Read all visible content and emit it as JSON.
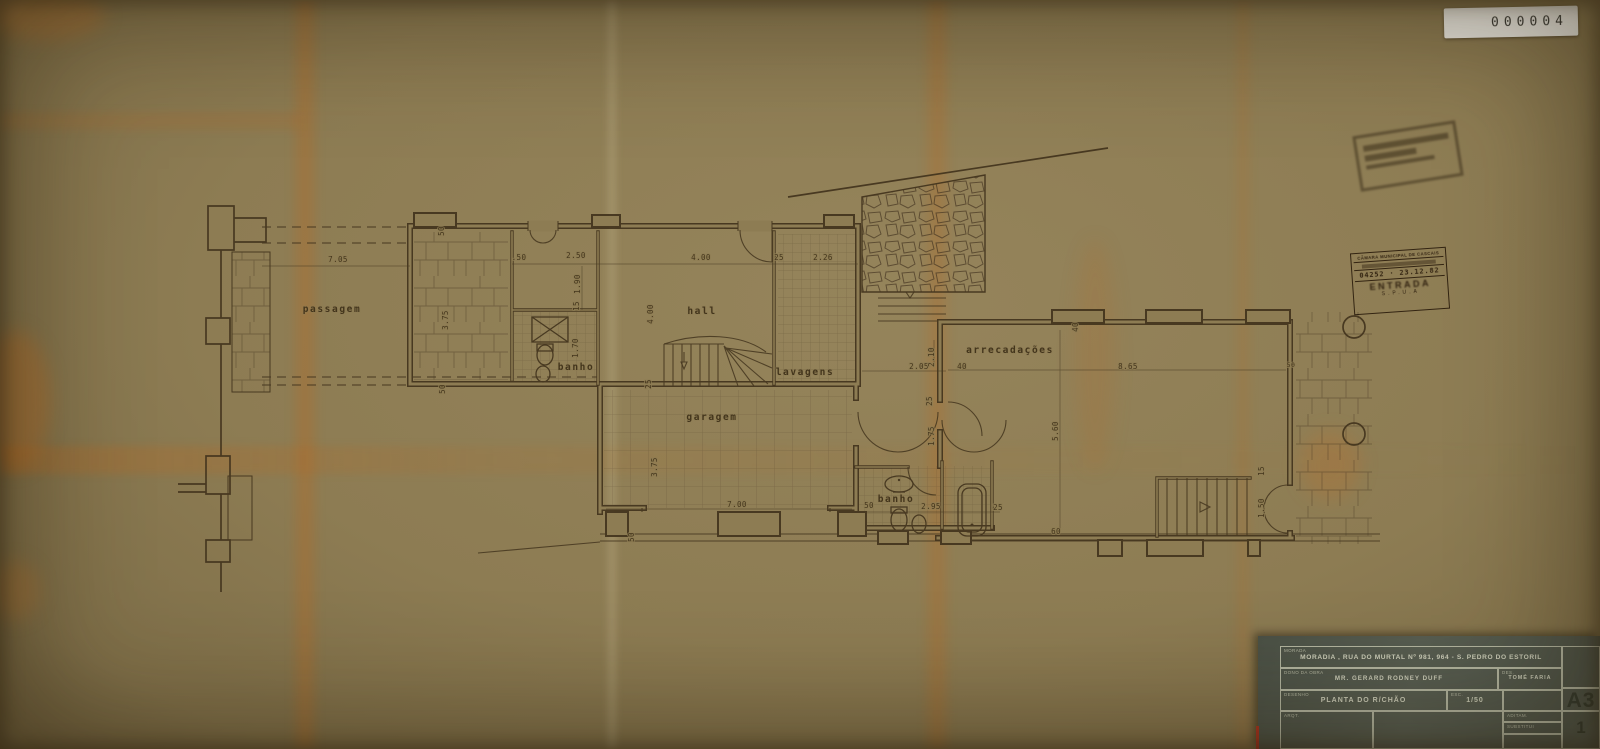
{
  "page": {
    "serial": "000004"
  },
  "stamps": {
    "entry": {
      "org": "CÂMARA MUNICIPAL DE CASCAIS",
      "number": "04252 · 23.12.82",
      "word": "ENTRADA",
      "dept": "S.P.U.A"
    }
  },
  "titleblock": {
    "address_label": "MORADA",
    "address": "MORADIA , RUA DO MURTAL Nº 981, 964 - S. PEDRO DO ESTORIL",
    "owner_label": "DONO DA OBRA",
    "owner": "MR. GERARD RODNEY DUFF",
    "designer_label": "DES.",
    "designer": "TOMÉ FARIA",
    "drawing_label": "DESENHO",
    "drawing": "PLANTA DO R/CHÃO",
    "scale_label": "ESC.",
    "scale": "1/50",
    "row4_label": "ARQT.",
    "aux_label_1": "ADITAM.",
    "aux_label_2": "SUBSTITUI",
    "sheet_format": "A3",
    "sheet_number": "1"
  },
  "plan": {
    "rooms": [
      {
        "label": "passagem"
      },
      {
        "label": "banho"
      },
      {
        "label": "hall"
      },
      {
        "label": "lavagens"
      },
      {
        "label": "garagem"
      },
      {
        "label": "arrecadações"
      },
      {
        "label": "banho"
      }
    ],
    "dims": [
      "7.05",
      "50",
      ".50",
      "2.50",
      "1.90",
      "15",
      "3.75",
      "50",
      "1.70",
      "4.00",
      "25",
      "2.26",
      "4.00",
      "25",
      "2.05",
      "2.10",
      "40",
      "25",
      "1.75",
      "8.65",
      "40",
      "3.75",
      "7.00",
      "50",
      "2.95",
      "25",
      "5.60",
      "60",
      "50",
      "15",
      "1.50",
      "50"
    ]
  }
}
